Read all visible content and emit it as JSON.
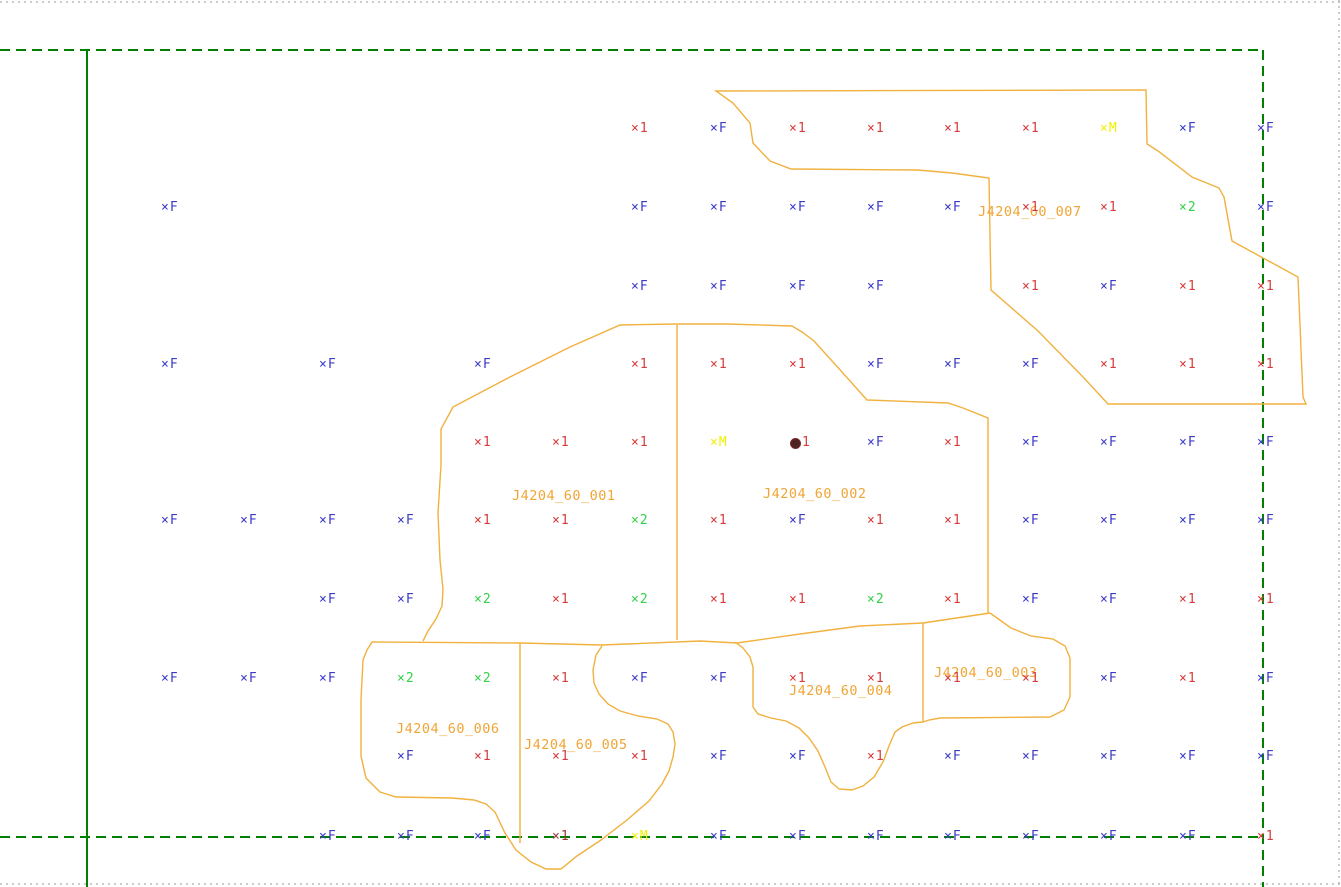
{
  "meta": {
    "width": 1341,
    "height": 887,
    "background": "#ffffff"
  },
  "colors": {
    "boundary_green": "#008000",
    "parcel_line_orange": "#f0b13e",
    "parcel_label_orange": "#f0a535",
    "marker_F_blue": "#3b3bc8",
    "marker_1_red": "#d83b3b",
    "marker_1_darkred": "#9a3737",
    "marker_2_green": "#35d04a",
    "marker_M_yellow": "#f0f000",
    "dot_fill_maroon": "#4d2222",
    "dot_edge": "#7a2a2a",
    "sheet_gray": "#9a9a9a"
  },
  "boundary_lines": [
    {
      "name": "sheet-border-top",
      "style": "dotted",
      "color": "sheet_gray",
      "points": [
        [
          0,
          2
        ],
        [
          1341,
          2
        ]
      ]
    },
    {
      "name": "sheet-border-bottom",
      "style": "dotted",
      "color": "sheet_gray",
      "points": [
        [
          0,
          884
        ],
        [
          1341,
          884
        ]
      ]
    },
    {
      "name": "sheet-border-right",
      "style": "dotted",
      "color": "sheet_gray",
      "points": [
        [
          1339,
          0
        ],
        [
          1339,
          887
        ]
      ]
    },
    {
      "name": "block-boundary-top",
      "style": "dashed",
      "color": "boundary_green",
      "points": [
        [
          0,
          50
        ],
        [
          1263,
          50
        ]
      ]
    },
    {
      "name": "block-boundary-right",
      "style": "dashed",
      "color": "boundary_green",
      "points": [
        [
          1263,
          50
        ],
        [
          1263,
          887
        ]
      ]
    },
    {
      "name": "block-boundary-bottom",
      "style": "dashed",
      "color": "boundary_green",
      "points": [
        [
          0,
          837
        ],
        [
          1263,
          837
        ]
      ]
    },
    {
      "name": "block-boundary-left-solid",
      "style": "solid",
      "color": "boundary_green",
      "points": [
        [
          87,
          50
        ],
        [
          87,
          887
        ]
      ]
    }
  ],
  "parcel_outlines": [
    {
      "name": "parcel-007-outline",
      "closed": true,
      "points": [
        [
          716,
          91
        ],
        [
          1146,
          90
        ],
        [
          1147,
          144
        ],
        [
          1158,
          151
        ],
        [
          1192,
          177
        ],
        [
          1219,
          188
        ],
        [
          1224,
          197
        ],
        [
          1232,
          241
        ],
        [
          1298,
          277
        ],
        [
          1303,
          397
        ],
        [
          1306,
          404
        ],
        [
          1108,
          404
        ],
        [
          1084,
          378
        ],
        [
          1038,
          331
        ],
        [
          991,
          290
        ],
        [
          989,
          178
        ],
        [
          952,
          173
        ],
        [
          918,
          170
        ],
        [
          791,
          169
        ],
        [
          770,
          161
        ],
        [
          753,
          143
        ],
        [
          750,
          123
        ],
        [
          733,
          103
        ]
      ]
    },
    {
      "name": "parcel-001-002-outer",
      "closed": false,
      "points": [
        [
          423,
          641
        ],
        [
          428,
          631
        ],
        [
          436,
          619
        ],
        [
          442,
          606
        ],
        [
          443,
          589
        ],
        [
          440,
          560
        ],
        [
          438,
          513
        ],
        [
          441,
          465
        ],
        [
          441,
          429
        ],
        [
          453,
          407
        ],
        [
          510,
          377
        ],
        [
          570,
          347
        ],
        [
          620,
          325
        ],
        [
          677,
          324
        ],
        [
          727,
          324
        ],
        [
          792,
          326
        ],
        [
          802,
          332
        ],
        [
          814,
          341
        ],
        [
          842,
          372
        ],
        [
          867,
          400
        ],
        [
          948,
          403
        ],
        [
          963,
          408
        ],
        [
          988,
          418
        ],
        [
          988,
          613
        ]
      ]
    },
    {
      "name": "parcel-001-002-divider",
      "closed": false,
      "points": [
        [
          677,
          325
        ],
        [
          677,
          640
        ]
      ]
    },
    {
      "name": "bottom-parcels-top-boundary",
      "closed": false,
      "points": [
        [
          372,
          642
        ],
        [
          520,
          643
        ],
        [
          602,
          645
        ],
        [
          700,
          641
        ],
        [
          737,
          643
        ],
        [
          800,
          634
        ],
        [
          860,
          626
        ],
        [
          923,
          623
        ],
        [
          990,
          613
        ]
      ]
    },
    {
      "name": "parcel-006-005-outer",
      "closed": false,
      "points": [
        [
          602,
          646
        ],
        [
          596,
          655
        ],
        [
          593,
          670
        ],
        [
          594,
          683
        ],
        [
          599,
          694
        ],
        [
          608,
          704
        ],
        [
          620,
          711
        ],
        [
          638,
          716
        ],
        [
          657,
          719
        ],
        [
          668,
          724
        ],
        [
          673,
          732
        ],
        [
          675,
          744
        ],
        [
          673,
          757
        ],
        [
          669,
          771
        ],
        [
          662,
          784
        ],
        [
          649,
          801
        ],
        [
          627,
          820
        ],
        [
          601,
          840
        ],
        [
          577,
          856
        ],
        [
          561,
          869
        ],
        [
          546,
          869
        ],
        [
          531,
          862
        ],
        [
          516,
          850
        ],
        [
          505,
          833
        ],
        [
          495,
          812
        ],
        [
          486,
          804
        ],
        [
          474,
          800
        ],
        [
          452,
          798
        ],
        [
          396,
          797
        ],
        [
          380,
          792
        ],
        [
          366,
          778
        ],
        [
          361,
          756
        ],
        [
          361,
          700
        ],
        [
          363,
          660
        ],
        [
          367,
          650
        ],
        [
          372,
          642
        ]
      ]
    },
    {
      "name": "parcel-006-005-divider",
      "closed": false,
      "points": [
        [
          520,
          643
        ],
        [
          520,
          843
        ]
      ]
    },
    {
      "name": "parcel-004-outline",
      "closed": false,
      "points": [
        [
          735,
          642
        ],
        [
          743,
          648
        ],
        [
          750,
          657
        ],
        [
          753,
          667
        ],
        [
          753,
          707
        ],
        [
          758,
          714
        ],
        [
          771,
          718
        ],
        [
          786,
          721
        ],
        [
          799,
          728
        ],
        [
          809,
          738
        ],
        [
          818,
          751
        ],
        [
          825,
          767
        ],
        [
          831,
          782
        ],
        [
          839,
          789
        ],
        [
          852,
          790
        ],
        [
          863,
          786
        ],
        [
          874,
          777
        ],
        [
          883,
          762
        ],
        [
          889,
          746
        ],
        [
          895,
          732
        ],
        [
          902,
          727
        ],
        [
          913,
          723
        ],
        [
          923,
          722
        ]
      ]
    },
    {
      "name": "parcel-004-003-divider",
      "closed": false,
      "points": [
        [
          923,
          623
        ],
        [
          923,
          722
        ]
      ]
    },
    {
      "name": "parcel-003-outline",
      "closed": false,
      "points": [
        [
          990,
          613
        ],
        [
          997,
          618
        ],
        [
          1011,
          628
        ],
        [
          1031,
          636
        ],
        [
          1053,
          639
        ],
        [
          1065,
          646
        ],
        [
          1070,
          658
        ],
        [
          1070,
          697
        ],
        [
          1064,
          710
        ],
        [
          1050,
          717
        ],
        [
          940,
          718
        ],
        [
          929,
          720
        ],
        [
          923,
          722
        ]
      ]
    }
  ],
  "parcel_labels": [
    {
      "text": "J4204_60_001",
      "x": 512,
      "y": 489
    },
    {
      "text": "J4204_60_002",
      "x": 763,
      "y": 487
    },
    {
      "text": "J4204_60_003",
      "x": 934,
      "y": 666
    },
    {
      "text": "J4204_60_004",
      "x": 789,
      "y": 684
    },
    {
      "text": "J4204_60_005",
      "x": 524,
      "y": 738
    },
    {
      "text": "J4204_60_006",
      "x": 396,
      "y": 722
    },
    {
      "text": "J4204_60_007",
      "x": 978,
      "y": 205
    }
  ],
  "marker_types": {
    "F": {
      "glyph": "×",
      "label": "F",
      "color": "marker_F_blue"
    },
    "1": {
      "glyph": "×",
      "label": "1",
      "color": "marker_1_red"
    },
    "1d": {
      "glyph": "×",
      "label": "1",
      "color": "marker_1_darkred"
    },
    "2": {
      "glyph": "×",
      "label": "2",
      "color": "marker_2_green"
    },
    "M": {
      "glyph": "×",
      "label": "M",
      "color": "marker_M_yellow"
    },
    "dot": {
      "glyph": "●",
      "label": "1",
      "color": "marker_1_red"
    }
  },
  "markers": [
    {
      "x": 637,
      "y": 129,
      "t": "1"
    },
    {
      "x": 716,
      "y": 129,
      "t": "F"
    },
    {
      "x": 795,
      "y": 129,
      "t": "1"
    },
    {
      "x": 873,
      "y": 129,
      "t": "1"
    },
    {
      "x": 950,
      "y": 129,
      "t": "1"
    },
    {
      "x": 1028,
      "y": 129,
      "t": "1"
    },
    {
      "x": 1106,
      "y": 129,
      "t": "M"
    },
    {
      "x": 1185,
      "y": 129,
      "t": "F"
    },
    {
      "x": 1263,
      "y": 129,
      "t": "F"
    },
    {
      "x": 167,
      "y": 208,
      "t": "F"
    },
    {
      "x": 637,
      "y": 208,
      "t": "F"
    },
    {
      "x": 716,
      "y": 208,
      "t": "F"
    },
    {
      "x": 795,
      "y": 208,
      "t": "F"
    },
    {
      "x": 873,
      "y": 208,
      "t": "F"
    },
    {
      "x": 950,
      "y": 208,
      "t": "F"
    },
    {
      "x": 1028,
      "y": 208,
      "t": "1"
    },
    {
      "x": 1106,
      "y": 208,
      "t": "1"
    },
    {
      "x": 1185,
      "y": 208,
      "t": "2"
    },
    {
      "x": 1263,
      "y": 208,
      "t": "F"
    },
    {
      "x": 637,
      "y": 287,
      "t": "F"
    },
    {
      "x": 716,
      "y": 287,
      "t": "F"
    },
    {
      "x": 795,
      "y": 287,
      "t": "F"
    },
    {
      "x": 873,
      "y": 287,
      "t": "F"
    },
    {
      "x": 1028,
      "y": 287,
      "t": "1"
    },
    {
      "x": 1106,
      "y": 287,
      "t": "F"
    },
    {
      "x": 1185,
      "y": 287,
      "t": "1"
    },
    {
      "x": 1263,
      "y": 287,
      "t": "1"
    },
    {
      "x": 167,
      "y": 365,
      "t": "F"
    },
    {
      "x": 325,
      "y": 365,
      "t": "F"
    },
    {
      "x": 480,
      "y": 365,
      "t": "F"
    },
    {
      "x": 637,
      "y": 365,
      "t": "1"
    },
    {
      "x": 716,
      "y": 365,
      "t": "1"
    },
    {
      "x": 795,
      "y": 365,
      "t": "1"
    },
    {
      "x": 873,
      "y": 365,
      "t": "F"
    },
    {
      "x": 950,
      "y": 365,
      "t": "F"
    },
    {
      "x": 1028,
      "y": 365,
      "t": "F"
    },
    {
      "x": 1106,
      "y": 365,
      "t": "1"
    },
    {
      "x": 1185,
      "y": 365,
      "t": "1"
    },
    {
      "x": 1263,
      "y": 365,
      "t": "1"
    },
    {
      "x": 480,
      "y": 443,
      "t": "1"
    },
    {
      "x": 558,
      "y": 443,
      "t": "1"
    },
    {
      "x": 637,
      "y": 443,
      "t": "1"
    },
    {
      "x": 716,
      "y": 443,
      "t": "M"
    },
    {
      "x": 795,
      "y": 443,
      "t": "dot"
    },
    {
      "x": 873,
      "y": 443,
      "t": "F"
    },
    {
      "x": 950,
      "y": 443,
      "t": "1"
    },
    {
      "x": 1028,
      "y": 443,
      "t": "F"
    },
    {
      "x": 1106,
      "y": 443,
      "t": "F"
    },
    {
      "x": 1185,
      "y": 443,
      "t": "F"
    },
    {
      "x": 1263,
      "y": 443,
      "t": "F"
    },
    {
      "x": 167,
      "y": 521,
      "t": "F"
    },
    {
      "x": 246,
      "y": 521,
      "t": "F"
    },
    {
      "x": 325,
      "y": 521,
      "t": "F"
    },
    {
      "x": 403,
      "y": 521,
      "t": "F"
    },
    {
      "x": 480,
      "y": 521,
      "t": "1"
    },
    {
      "x": 558,
      "y": 521,
      "t": "1"
    },
    {
      "x": 637,
      "y": 521,
      "t": "2"
    },
    {
      "x": 716,
      "y": 521,
      "t": "1"
    },
    {
      "x": 795,
      "y": 521,
      "t": "F"
    },
    {
      "x": 873,
      "y": 521,
      "t": "1"
    },
    {
      "x": 950,
      "y": 521,
      "t": "1"
    },
    {
      "x": 1028,
      "y": 521,
      "t": "F"
    },
    {
      "x": 1106,
      "y": 521,
      "t": "F"
    },
    {
      "x": 1185,
      "y": 521,
      "t": "F"
    },
    {
      "x": 1263,
      "y": 521,
      "t": "F"
    },
    {
      "x": 325,
      "y": 600,
      "t": "F"
    },
    {
      "x": 403,
      "y": 600,
      "t": "F"
    },
    {
      "x": 480,
      "y": 600,
      "t": "2"
    },
    {
      "x": 558,
      "y": 600,
      "t": "1"
    },
    {
      "x": 637,
      "y": 600,
      "t": "2"
    },
    {
      "x": 716,
      "y": 600,
      "t": "1"
    },
    {
      "x": 795,
      "y": 600,
      "t": "1"
    },
    {
      "x": 873,
      "y": 600,
      "t": "2"
    },
    {
      "x": 950,
      "y": 600,
      "t": "1"
    },
    {
      "x": 1028,
      "y": 600,
      "t": "F"
    },
    {
      "x": 1106,
      "y": 600,
      "t": "F"
    },
    {
      "x": 1185,
      "y": 600,
      "t": "1"
    },
    {
      "x": 1263,
      "y": 600,
      "t": "1"
    },
    {
      "x": 167,
      "y": 679,
      "t": "F"
    },
    {
      "x": 246,
      "y": 679,
      "t": "F"
    },
    {
      "x": 325,
      "y": 679,
      "t": "F"
    },
    {
      "x": 403,
      "y": 679,
      "t": "2"
    },
    {
      "x": 480,
      "y": 679,
      "t": "2"
    },
    {
      "x": 558,
      "y": 679,
      "t": "1"
    },
    {
      "x": 637,
      "y": 679,
      "t": "F"
    },
    {
      "x": 716,
      "y": 679,
      "t": "F"
    },
    {
      "x": 795,
      "y": 679,
      "t": "1"
    },
    {
      "x": 873,
      "y": 679,
      "t": "1"
    },
    {
      "x": 950,
      "y": 679,
      "t": "1"
    },
    {
      "x": 1028,
      "y": 679,
      "t": "1"
    },
    {
      "x": 1106,
      "y": 679,
      "t": "F"
    },
    {
      "x": 1185,
      "y": 679,
      "t": "1"
    },
    {
      "x": 1263,
      "y": 679,
      "t": "F"
    },
    {
      "x": 403,
      "y": 757,
      "t": "F"
    },
    {
      "x": 480,
      "y": 757,
      "t": "1"
    },
    {
      "x": 558,
      "y": 757,
      "t": "1"
    },
    {
      "x": 637,
      "y": 757,
      "t": "1"
    },
    {
      "x": 716,
      "y": 757,
      "t": "F"
    },
    {
      "x": 795,
      "y": 757,
      "t": "F"
    },
    {
      "x": 873,
      "y": 757,
      "t": "1"
    },
    {
      "x": 950,
      "y": 757,
      "t": "F"
    },
    {
      "x": 1028,
      "y": 757,
      "t": "F"
    },
    {
      "x": 1106,
      "y": 757,
      "t": "F"
    },
    {
      "x": 1185,
      "y": 757,
      "t": "F"
    },
    {
      "x": 1263,
      "y": 757,
      "t": "F"
    },
    {
      "x": 325,
      "y": 837,
      "t": "F"
    },
    {
      "x": 403,
      "y": 837,
      "t": "F"
    },
    {
      "x": 480,
      "y": 837,
      "t": "F"
    },
    {
      "x": 558,
      "y": 837,
      "t": "1d"
    },
    {
      "x": 637,
      "y": 837,
      "t": "M"
    },
    {
      "x": 716,
      "y": 837,
      "t": "F"
    },
    {
      "x": 795,
      "y": 837,
      "t": "F"
    },
    {
      "x": 873,
      "y": 837,
      "t": "F"
    },
    {
      "x": 950,
      "y": 837,
      "t": "F"
    },
    {
      "x": 1028,
      "y": 837,
      "t": "F"
    },
    {
      "x": 1106,
      "y": 837,
      "t": "F"
    },
    {
      "x": 1185,
      "y": 837,
      "t": "F"
    },
    {
      "x": 1263,
      "y": 837,
      "t": "1"
    }
  ]
}
